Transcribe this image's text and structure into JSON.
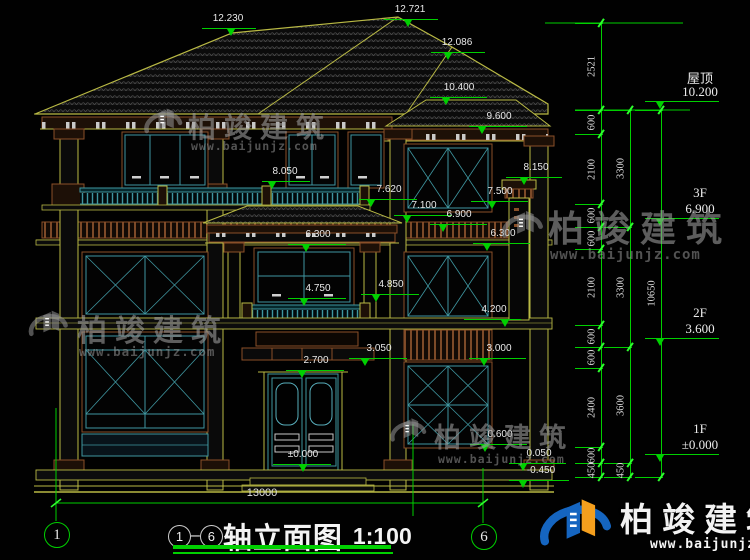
{
  "title": {
    "axis_start": "1",
    "separator": "–",
    "axis_end": "6",
    "name": "轴立面图",
    "scale": "1:100"
  },
  "watermark": {
    "brand": "柏竣建筑",
    "url": "www.baijunjz.com"
  },
  "axis_bubbles": [
    {
      "label": "1",
      "x": 56,
      "y": 534
    },
    {
      "label": "6",
      "x": 483,
      "y": 536
    }
  ],
  "bottom_dim": {
    "text": "13000"
  },
  "elevations": [
    {
      "t": "12.230",
      "x": 228,
      "y": 13,
      "l1": 202,
      "l2": 256,
      "ly": 28,
      "tx": 231
    },
    {
      "t": "12.721",
      "x": 410,
      "y": 4,
      "l1": 384,
      "l2": 438,
      "ly": 19,
      "tx": 408
    },
    {
      "t": "12.086",
      "x": 457,
      "y": 37,
      "l1": 431,
      "l2": 485,
      "ly": 52,
      "tx": 448
    },
    {
      "t": "10.400",
      "x": 459,
      "y": 82,
      "l1": 430,
      "l2": 487,
      "ly": 97,
      "tx": 446
    },
    {
      "t": "9.600",
      "x": 499,
      "y": 111,
      "l1": 469,
      "l2": 527,
      "ly": 126,
      "tx": 482
    },
    {
      "t": "8.050",
      "x": 285,
      "y": 166,
      "l1": 262,
      "l2": 310,
      "ly": 181,
      "tx": 272
    },
    {
      "t": "8.150",
      "x": 536,
      "y": 162,
      "l1": 506,
      "l2": 562,
      "ly": 177,
      "tx": 524
    },
    {
      "t": "7.620",
      "x": 389,
      "y": 184,
      "l1": 359,
      "l2": 417,
      "ly": 199,
      "tx": 371
    },
    {
      "t": "7.500",
      "x": 500,
      "y": 186,
      "l1": 471,
      "l2": 528,
      "ly": 201,
      "tx": 492
    },
    {
      "t": "7.100",
      "x": 424,
      "y": 200,
      "l1": 394,
      "l2": 452,
      "ly": 215,
      "tx": 407
    },
    {
      "t": "6.900",
      "x": 459,
      "y": 209,
      "l1": 430,
      "l2": 487,
      "ly": 224,
      "tx": 443
    },
    {
      "t": "6.300",
      "x": 318,
      "y": 229,
      "l1": 288,
      "l2": 346,
      "ly": 244,
      "tx": 306
    },
    {
      "t": "6.300",
      "x": 503,
      "y": 228,
      "l1": 473,
      "l2": 530,
      "ly": 243,
      "tx": 487
    },
    {
      "t": "4.750",
      "x": 318,
      "y": 283,
      "l1": 288,
      "l2": 346,
      "ly": 298,
      "tx": 304
    },
    {
      "t": "4.850",
      "x": 391,
      "y": 279,
      "l1": 361,
      "l2": 419,
      "ly": 294,
      "tx": 376
    },
    {
      "t": "4.200",
      "x": 494,
      "y": 304,
      "l1": 464,
      "l2": 521,
      "ly": 319,
      "tx": 505
    },
    {
      "t": "3.050",
      "x": 379,
      "y": 343,
      "l1": 349,
      "l2": 407,
      "ly": 358,
      "tx": 365
    },
    {
      "t": "3.000",
      "x": 499,
      "y": 343,
      "l1": 469,
      "l2": 526,
      "ly": 358,
      "tx": 484
    },
    {
      "t": "2.700",
      "x": 316,
      "y": 355,
      "l1": 286,
      "l2": 344,
      "ly": 370,
      "tx": 302
    },
    {
      "t": "0.600",
      "x": 500,
      "y": 429,
      "l1": 470,
      "l2": 527,
      "ly": 444,
      "tx": 485
    },
    {
      "t": "0.050",
      "x": 539,
      "y": 448,
      "l1": 509,
      "l2": 566,
      "ly": 463,
      "tx": 523
    },
    {
      "t": "-0.450",
      "x": 541,
      "y": 465,
      "l1": 509,
      "l2": 569,
      "ly": 480,
      "tx": 523
    },
    {
      "t": "±0.000",
      "x": 303,
      "y": 449,
      "l1": 273,
      "l2": 331,
      "ly": 464,
      "tx": 303
    }
  ],
  "floor_markers": [
    {
      "floor": "屋顶",
      "value": "10.200",
      "y": 110
    },
    {
      "floor": "3F",
      "value": "6.900",
      "y": 227
    },
    {
      "floor": "2F",
      "value": "3.600",
      "y": 347
    },
    {
      "floor": "1F",
      "value": "±0.000",
      "y": 463
    }
  ],
  "dim_chains": [
    {
      "x": 601,
      "ticks": [
        23,
        110,
        134,
        204,
        227,
        249,
        325,
        347,
        368,
        447,
        463,
        477
      ],
      "segs": [
        {
          "t": "2521",
          "y": 66
        },
        {
          "t": "600",
          "y": 122
        },
        {
          "t": "2100",
          "y": 169
        },
        {
          "t": "600",
          "y": 215
        },
        {
          "t": "600",
          "y": 238
        },
        {
          "t": "2100",
          "y": 287
        },
        {
          "t": "600",
          "y": 336
        },
        {
          "t": "600",
          "y": 357
        },
        {
          "t": "2400",
          "y": 407
        },
        {
          "t": "600",
          "y": 455
        },
        {
          "t": "450",
          "y": 470
        }
      ]
    },
    {
      "x": 630,
      "ticks": [
        110,
        227,
        347,
        463,
        477
      ],
      "segs": [
        {
          "t": "3300",
          "y": 168
        },
        {
          "t": "3300",
          "y": 287
        },
        {
          "t": "3600",
          "y": 405
        },
        {
          "t": "450",
          "y": 470
        }
      ]
    },
    {
      "x": 661,
      "ticks": [
        110,
        477
      ],
      "segs": [
        {
          "t": "10650",
          "y": 293
        }
      ]
    }
  ],
  "watermarks": [
    {
      "style": "grey",
      "lx": 140,
      "ly": 104,
      "lw": 46,
      "tx": 188,
      "ty": 106,
      "tsize": 28,
      "ux": 191,
      "uy": 139,
      "usize": 11.5
    },
    {
      "style": "grey",
      "lx": 497,
      "ly": 206,
      "lw": 50,
      "tx": 548,
      "ty": 200,
      "tsize": 36,
      "ux": 550,
      "uy": 247,
      "usize": 14
    },
    {
      "style": "grey",
      "lx": 24,
      "ly": 306,
      "lw": 48,
      "tx": 77,
      "ty": 306,
      "tsize": 30,
      "ux": 79,
      "uy": 344,
      "usize": 12.5
    },
    {
      "style": "grey",
      "lx": 386,
      "ly": 414,
      "lw": 44,
      "tx": 434,
      "ty": 416,
      "tsize": 27,
      "ux": 438,
      "uy": 452,
      "usize": 11.5
    },
    {
      "style": "color",
      "lx": 532,
      "ly": 491,
      "lw": 86,
      "tx": 620,
      "ty": 493,
      "tsize": 33,
      "ux": 650,
      "uy": 537,
      "usize": 13
    }
  ],
  "colors": {
    "line_yellow": "#b9b944",
    "trim_brown": "#8a4f28",
    "frame_teal": "#3f96a0",
    "dim_green": "#00d000",
    "text_white": "#e9e9e9",
    "logo_blue": "#1565c0",
    "logo_orange": "#f59f1d"
  }
}
